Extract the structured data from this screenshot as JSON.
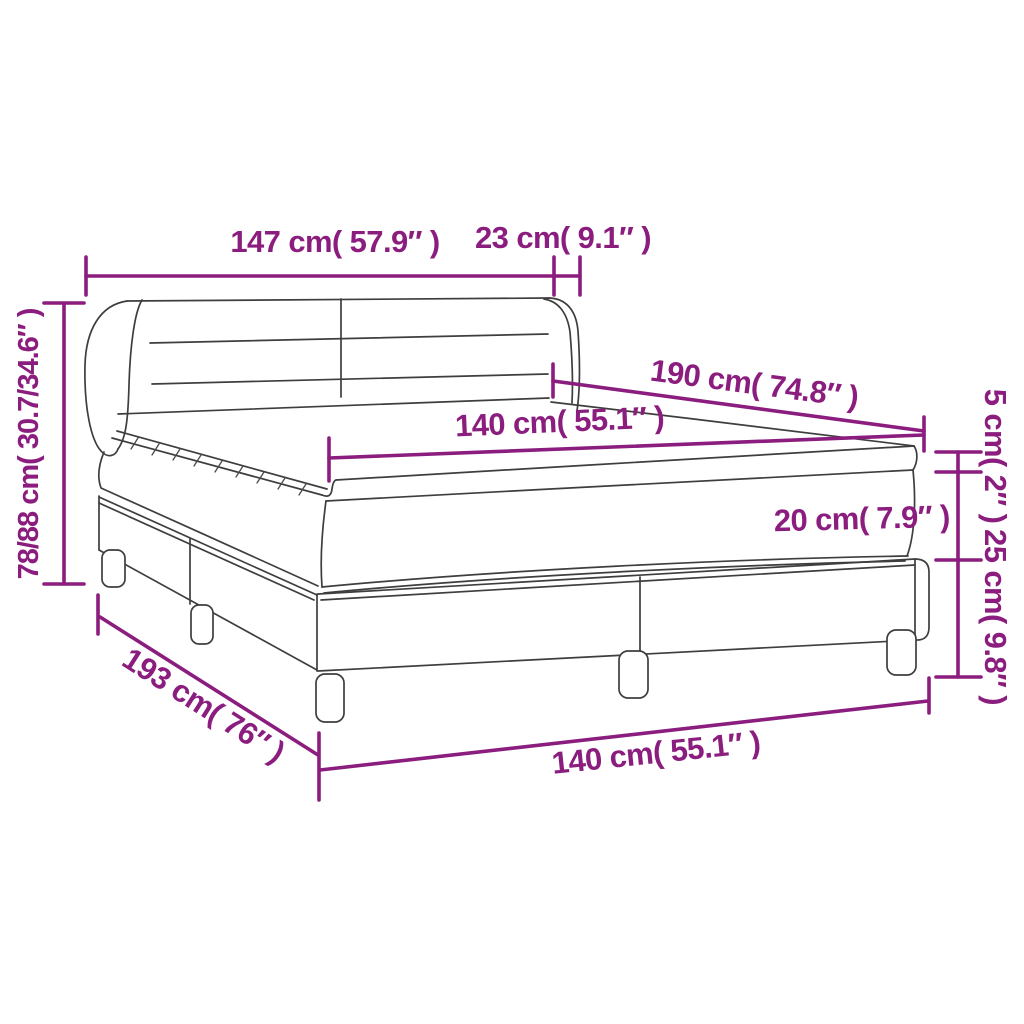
{
  "page": {
    "background": "#ffffff"
  },
  "diagram": {
    "title": "box-spring-bed-dimension-diagram",
    "colors": {
      "dimension_accent": "#8B1D7F",
      "line_art": "#3E3E3E",
      "background": "#FFFFFF"
    },
    "labels": {
      "headboard_width": "147 cm( 57.9″ )",
      "wing_depth": "23 cm( 9.1″ )",
      "overall_height": "78/88 cm( 30.7/34.6″ )",
      "mattress_length": "190 cm( 74.8″ )",
      "mattress_width_top": "140 cm( 55.1″ )",
      "topper_thickness": "5 cm( 2″ )",
      "mattress_thickness": "20 cm( 7.9″ )",
      "base_height": "25 cm( 9.8″ )",
      "base_length": "193 cm( 76″ )",
      "base_width": "140 cm( 55.1″ )"
    }
  }
}
